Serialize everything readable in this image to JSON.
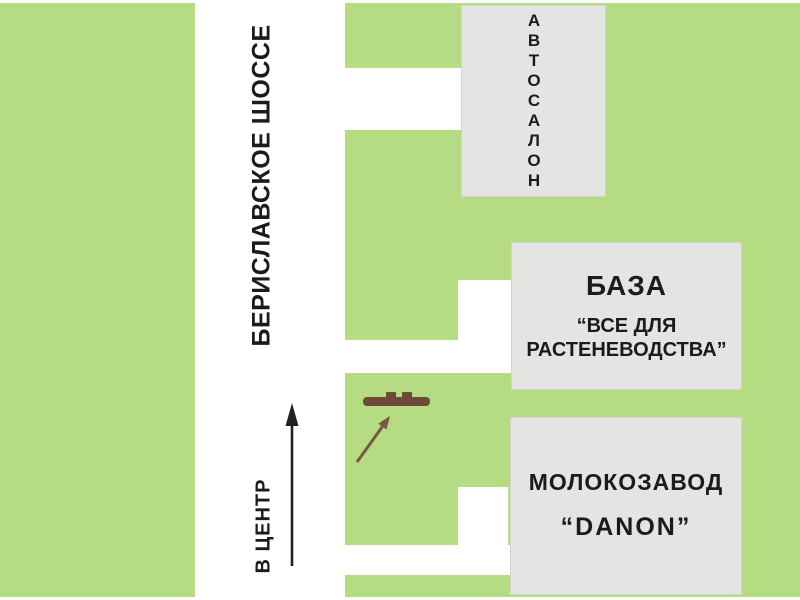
{
  "road": {
    "name": "БЕРИСЛАВСКОЕ ШОССЕ",
    "direction": "В ЦЕНТР"
  },
  "buildings": {
    "autosalon": {
      "label": "АВТОСАЛОН"
    },
    "baza": {
      "title": "БАЗА",
      "subtitle": "“ВСЕ ДЛЯ РАСТЕНЕВОДСТВА”"
    },
    "dairy": {
      "title": "МОЛОКОЗАВОД",
      "subtitle": "“DANON”"
    }
  },
  "marker": {
    "name": "advertised-location-marker"
  },
  "colors": {
    "green_area": "#b5dc82",
    "building_gray": "#e4e4e2",
    "marker_brown": "#6b4a3a",
    "pointer_brown": "#7a5743",
    "arrow_black": "#222222",
    "road_white": "#ffffff"
  }
}
